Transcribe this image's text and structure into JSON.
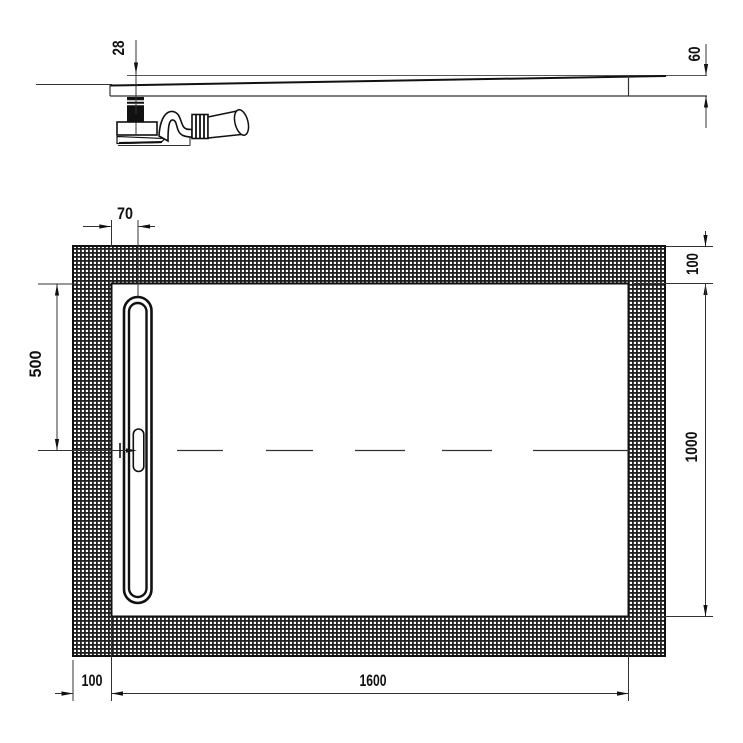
{
  "drawing": {
    "type": "shower-tray-technical-drawing",
    "colors": {
      "line": "#1a1a1a",
      "thin_line": "#333333",
      "background": "#ffffff"
    },
    "side_view": {
      "dimensions": {
        "depth_at_drain": "28",
        "edge_height": "60"
      }
    },
    "plan_view": {
      "dimensions": {
        "drain_offset_from_inner_edge": "70",
        "drain_center_from_top_inner_edge": "500",
        "border_width_top": "100",
        "inner_length": "1000",
        "border_width_left": "100",
        "inner_width": "1600"
      }
    }
  }
}
